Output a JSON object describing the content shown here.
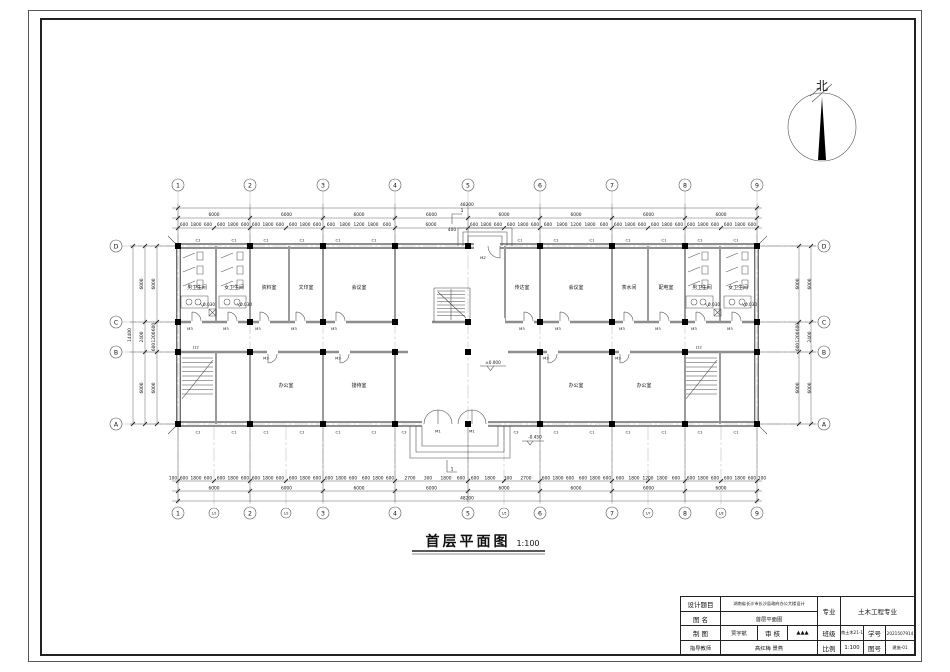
{
  "north": {
    "label": "北"
  },
  "plan_title": {
    "text": "首层平面图",
    "scale": "1:100"
  },
  "grid": {
    "x": [
      "1",
      "2",
      "3",
      "4",
      "5",
      "6",
      "7",
      "8",
      "9"
    ],
    "x_sub": [
      "1/1",
      "1/2",
      "1/5",
      "1/7",
      "1/8"
    ],
    "y_left": [
      "D",
      "C",
      "B",
      "A"
    ],
    "y_right": [
      "D",
      "C",
      "B",
      "A"
    ]
  },
  "dims": {
    "total_width": "48200",
    "bay_width": "6000",
    "top_small": [
      "600",
      "1800",
      "600",
      "600",
      "1800",
      "600",
      "600",
      "1800",
      "600",
      "600",
      "1800",
      "600",
      "600",
      "1800",
      "1200",
      "1800",
      "600",
      "6000",
      "600",
      "1800",
      "600",
      "600",
      "1800",
      "600",
      "600",
      "1800",
      "1200",
      "1800",
      "600",
      "600",
      "1800",
      "600",
      "600",
      "1800",
      "600",
      "600",
      "1800",
      "600",
      "600",
      "1800",
      "600"
    ],
    "bottom_small": [
      "600",
      "1800",
      "600",
      "600",
      "1800",
      "600",
      "600",
      "1800",
      "600",
      "600",
      "1800",
      "600",
      "600",
      "1800",
      "600",
      "600",
      "1800",
      "600",
      "2700",
      "300",
      "1800",
      "600",
      "600",
      "1800",
      "300",
      "2700",
      "600",
      "1800",
      "600",
      "600",
      "1800",
      "600",
      "600",
      "1800",
      "1200",
      "1800",
      "600",
      "600",
      "1800",
      "600",
      "600",
      "1800",
      "600"
    ],
    "total_height": "14400",
    "v_outer": [
      "6000",
      "2400",
      "6000"
    ],
    "v_inner_top": "6000",
    "v_inner_mid": [
      "600",
      "1200",
      "600"
    ],
    "v_inner_bottom": "6000",
    "end_offset": "100",
    "entry_dim": "400"
  },
  "rooms": {
    "top": [
      "男卫生间",
      "女卫生间",
      "资料室",
      "文印室",
      "会议室",
      "传达室",
      "会议室",
      "茶水间",
      "配电室",
      "男卫生间",
      "女卫生间"
    ],
    "bottom": [
      "办公室",
      "接待室",
      "办公室",
      "办公室"
    ]
  },
  "openings": {
    "window_main": "C1",
    "window_entry": "C3",
    "door_entry": "M1",
    "door_side": "M2",
    "door_room": "M3"
  },
  "levels": {
    "ground": "±0.000",
    "porch": "-0.450",
    "toilet": "0.030"
  },
  "stairs": {
    "label": "J12"
  },
  "sections": {
    "mark": "1"
  },
  "titleblock": {
    "design_title_label": "设计题目",
    "design_title": "湖南省长沙市长沙县政府办公大楼设计",
    "drawing_name_label": "图  名",
    "drawing_name": "首层平面图",
    "major_label": "专业",
    "major": "土木工程专业",
    "drafter_label": "制  图",
    "drafter": "贾宇航",
    "reviewer_label": "审  核",
    "reviewer": "▲▲▲",
    "class_label": "班级",
    "class": "中南土木21-1班",
    "student_id_label": "学号",
    "student_id": "2021507914",
    "advisor_label": "指导教师",
    "advisor": "高红梅  景燕",
    "scale_label": "比例",
    "scale": "1:100",
    "sheet_label": "图号",
    "sheet": "建施-01"
  }
}
